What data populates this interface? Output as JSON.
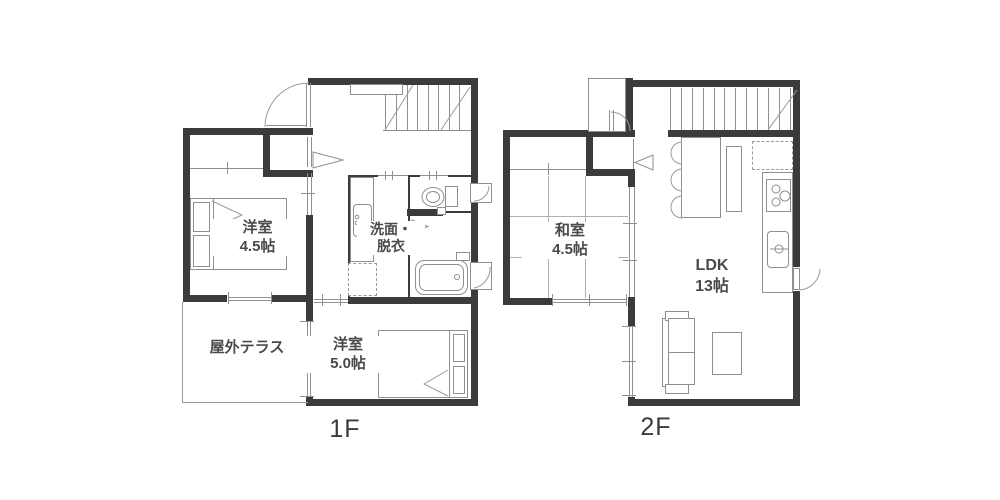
{
  "floor_1": {
    "label": "1F",
    "rooms": {
      "bedroom_small": {
        "line1": "洋室",
        "line2": "4.5帖"
      },
      "washroom": {
        "line1": "洗面・",
        "line2": "脱衣"
      },
      "terrace": {
        "line1": "屋外テラス"
      },
      "bedroom_large": {
        "line1": "洋室",
        "line2": "5.0帖"
      }
    }
  },
  "floor_2": {
    "label": "2F",
    "rooms": {
      "japanese_room": {
        "line1": "和室",
        "line2": "4.5帖"
      },
      "ldk": {
        "line1": "LDK",
        "line2": "13帖"
      }
    }
  },
  "colors": {
    "wall": "#3b3b3b",
    "line": "#8f8f8f",
    "text": "#4a4a4a",
    "background": "#ffffff"
  }
}
